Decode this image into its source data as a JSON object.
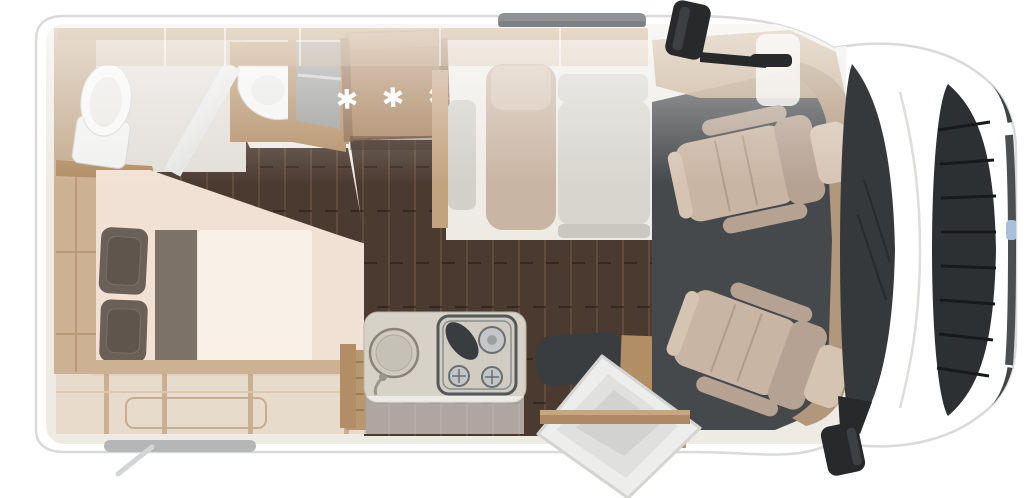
{
  "image": {
    "kind": "motorhome-floorplan-top-view",
    "orientation": "front-of-vehicle-right"
  },
  "fridge": {
    "rating_symbols": "✱ ✱ ✱"
  },
  "palette": {
    "body_white": "#ffffff",
    "body_edge": "#d9dadb",
    "interior_base": "#eeebe5",
    "wood": "#b28e66",
    "wood_dark": "#8f6c4c",
    "wood_light": "#cdb193",
    "wood_pale": "#e7d9c8",
    "floor_dark": "#4b3a30",
    "cab_mat": "#46494b",
    "seat_beige": "#c9b5a3",
    "seat_beige_dark": "#b6a292",
    "seat_beige_light": "#d6c4b3",
    "cushion_gray": "#d7d5ce",
    "pillow_brown": "#6b6058",
    "runner_taupe": "#7c7268",
    "duvet_cream": "#f8f1e8",
    "mattress_peach": "#f1e1d5",
    "bath_white": "#f4f4f2",
    "glass_dark": "#36393b",
    "grille_dark": "#2d3032",
    "mirror_black": "#27292b",
    "counter_greige": "#d7d2c7",
    "awning_gray": "#8f9396",
    "lamp_blue": "#a9c0da"
  }
}
